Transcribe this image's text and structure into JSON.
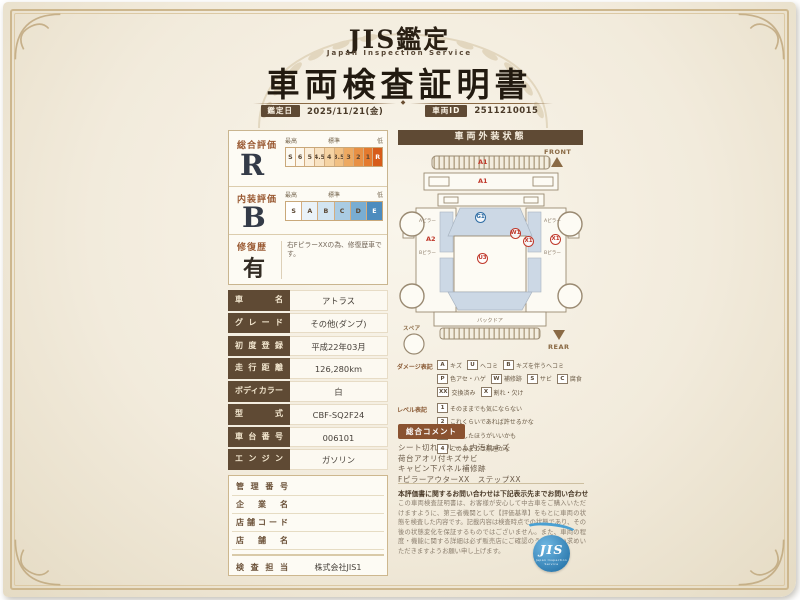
{
  "header": {
    "brand": "JIS鑑定",
    "brand_sub": "Japan Inspection Service",
    "title": "車両検査証明書",
    "date_chip": "鑑定日",
    "date_value": "2025/11/21(金)",
    "id_chip": "車両ID",
    "id_value": "2511210015"
  },
  "ratings": {
    "overall": {
      "label": "総合評価",
      "grade": "R",
      "legend_high": "最高",
      "legend_mid": "標準",
      "legend_low": "低",
      "cells": [
        {
          "v": "S",
          "bg": "#fdfaf2"
        },
        {
          "v": "6",
          "bg": "#fdf7ec"
        },
        {
          "v": "5",
          "bg": "#fbeeda"
        },
        {
          "v": "4.5",
          "bg": "#f8e2c2"
        },
        {
          "v": "4",
          "bg": "#f5d3a3"
        },
        {
          "v": "3.5",
          "bg": "#f1c083"
        },
        {
          "v": "3",
          "bg": "#eda961"
        },
        {
          "v": "2",
          "bg": "#e89044"
        },
        {
          "v": "1",
          "bg": "#e47a2e"
        },
        {
          "v": "R",
          "bg": "#d75c1a",
          "fg": "#ffffff"
        }
      ]
    },
    "interior": {
      "label": "内装評価",
      "grade": "B",
      "legend_high": "最高",
      "legend_mid": "標準",
      "legend_low": "低",
      "cells": [
        {
          "v": "S",
          "bg": "#ffffff"
        },
        {
          "v": "A",
          "bg": "#eaf2f8"
        },
        {
          "v": "B",
          "bg": "#d2e4f1"
        },
        {
          "v": "C",
          "bg": "#a9cbe3"
        },
        {
          "v": "D",
          "bg": "#79add2"
        },
        {
          "v": "E",
          "bg": "#4d8cbe",
          "fg": "#ffffff"
        }
      ]
    },
    "repair": {
      "label": "修復歴",
      "grade": "有",
      "note": "右FピラーXXの為、修復歴車です。"
    }
  },
  "vehicle": {
    "rows": [
      {
        "label": "車名",
        "value": "アトラス"
      },
      {
        "label": "グレード",
        "value": "その他(ダンプ)"
      },
      {
        "label": "初度登録",
        "value": "平成22年03月"
      },
      {
        "label": "走行距離",
        "value": "126,280km"
      },
      {
        "label": "ボディカラー",
        "value": "白"
      },
      {
        "label": "型式",
        "value": "CBF-SQ2F24"
      },
      {
        "label": "車台番号",
        "value": "006101"
      },
      {
        "label": "エンジン",
        "value": "ガソリン"
      }
    ]
  },
  "office": {
    "rows": [
      {
        "label": "管理番号",
        "value": ""
      },
      {
        "label": "企業名",
        "value": ""
      },
      {
        "label": "店舗コード",
        "value": ""
      },
      {
        "label": "店舗名",
        "value": ""
      }
    ],
    "inspector_label": "検査担当",
    "inspector_value": "株式会社JIS1"
  },
  "exterior": {
    "title": "車両外装状態",
    "front": "FRONT",
    "rear": "REAR",
    "spare": "スペア",
    "labels": {
      "pillar_a": "Aピラー",
      "pillar_b": "Bピラー",
      "backdoor": "バックドア"
    },
    "markers": [
      {
        "code": "A1",
        "style": "plain",
        "color": "#c0392b"
      },
      {
        "code": "A1",
        "style": "plain",
        "color": "#c0392b"
      },
      {
        "code": "G1",
        "style": "circle",
        "color": "#2e6da4"
      },
      {
        "code": "A2",
        "style": "plain",
        "color": "#c0392b"
      },
      {
        "code": "U3",
        "style": "circle",
        "color": "#c0392b"
      },
      {
        "code": "W1",
        "style": "circle",
        "color": "#c0392b"
      },
      {
        "code": "X1",
        "style": "circle",
        "color": "#c0392b"
      },
      {
        "code": "X1",
        "style": "circle",
        "color": "#c0392b"
      }
    ]
  },
  "legend": {
    "damage_label": "ダメージ表記",
    "damage": [
      {
        "code": "A",
        "text": "キズ"
      },
      {
        "code": "U",
        "text": "ヘコミ"
      },
      {
        "code": "B",
        "text": "キズを伴うヘコミ"
      },
      {
        "code": "P",
        "text": "色アセ・ハゲ"
      },
      {
        "code": "W",
        "text": "補修跡"
      },
      {
        "code": "S",
        "text": "サビ"
      },
      {
        "code": "C",
        "text": "腐食"
      },
      {
        "code": "XX",
        "text": "交換済み"
      },
      {
        "code": "X",
        "text": "割れ・欠け"
      }
    ],
    "level_label": "レベル表記",
    "levels": [
      {
        "code": "1",
        "text": "そのままでも気にならない"
      },
      {
        "code": "2",
        "text": "これくらいであれば許せるかな"
      },
      {
        "code": "3",
        "text": "修理したほうがいいかも"
      },
      {
        "code": "4",
        "text": "このままでは無理かな"
      }
    ]
  },
  "comments": {
    "title": "総合コメント",
    "lines": [
      "シート切れ　ルーム内汚れキズ",
      "荷台アオリ付キズサビ",
      "キャビン下パネル補修跡",
      "FピラーアウターXX　ステップXX"
    ]
  },
  "footer": {
    "contact": "本評価書に関するお問い合わせは下記表示先までお問い合わせいたします。",
    "body": "この車両検査証明書は、お客様が安心して中古車をご購入いただけますように、第三者機関として【評価基準】をもとに車両の状態を検査した内容です。記載内容は検査時点での状態であり、その後の状態変化を保証するものではございません。また、車両の程度・機能に関する詳細は必ず販売店にご確認のうえお買い求めいただきますようお願い申し上げます。",
    "logo": "JIS",
    "logo_sub": "Japan Inspection Service"
  }
}
